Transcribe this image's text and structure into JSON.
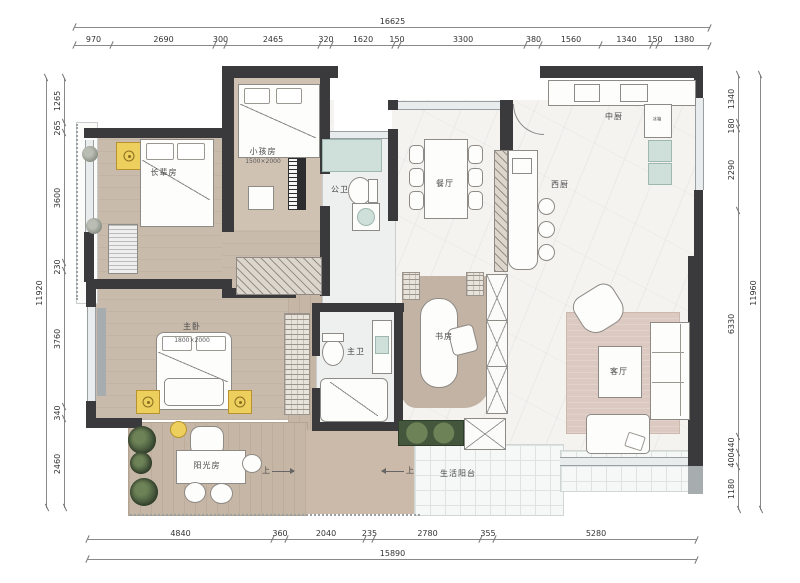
{
  "dims": {
    "top": {
      "total": "16625",
      "segments": [
        "970",
        "2690",
        "300",
        "2465",
        "320",
        "1620",
        "150",
        "3300",
        "380",
        "1560",
        "1340",
        "150",
        "1380"
      ]
    },
    "bottom": {
      "total": "15890",
      "segments": [
        "4840",
        "360",
        "2040",
        "235",
        "2780",
        "355",
        "5280"
      ]
    },
    "left": {
      "total": "11920",
      "segments": [
        "1265",
        "265",
        "3600",
        "230",
        "3760",
        "340",
        "2460"
      ]
    },
    "right": {
      "total": "11960",
      "segments": [
        "1340",
        "180",
        "2290",
        "6330",
        "440",
        "400",
        "1180"
      ]
    }
  },
  "rooms": {
    "elder_room": {
      "label": "长辈房"
    },
    "kids_room": {
      "label": "小孩房",
      "bed_size": "1500×2000"
    },
    "guest_bath": {
      "label": "公卫"
    },
    "dining": {
      "label": "餐厅"
    },
    "chinese_kitchen": {
      "label": "中厨"
    },
    "western_kitchen": {
      "label": "西厨"
    },
    "master_bedroom": {
      "label": "主卧",
      "bed_size": "1800×2000"
    },
    "master_bath": {
      "label": "主卫"
    },
    "study": {
      "label": "书房"
    },
    "living": {
      "label": "客厅"
    },
    "sunroom": {
      "label": "阳光房"
    },
    "service_balcony": {
      "label": "生活阳台"
    },
    "fridge": {
      "label": "冰箱"
    }
  },
  "annotations": {
    "up_left": "上",
    "up_right": "上"
  },
  "colors": {
    "wall": "#3a3a3c",
    "accent_yellow": "#eccf5c",
    "teal": "#cfe0da",
    "wood": "#c9bbac",
    "rug": "#dccac2",
    "planter_green": "#44563c"
  }
}
